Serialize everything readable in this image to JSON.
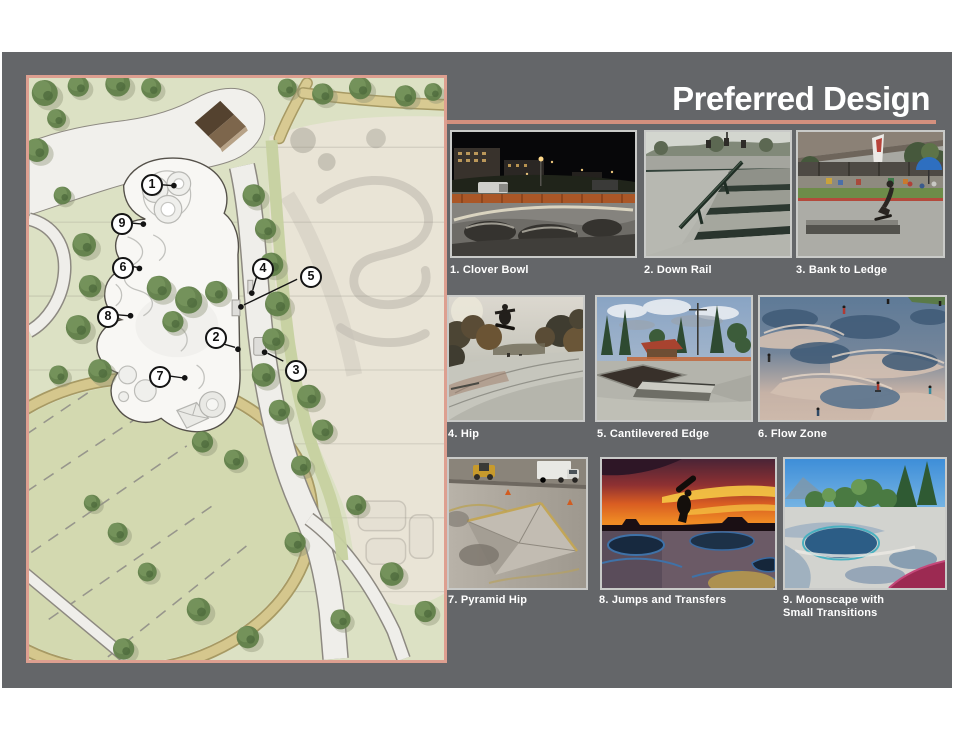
{
  "slide": {
    "title": "Preferred Design"
  },
  "colors": {
    "background": "#646669",
    "accent_salmon": "#dd9f90",
    "title_text": "#ffffff",
    "caption_text": "#ffffff",
    "photo_frame": "#c9cac8"
  },
  "site_plan": {
    "callouts": [
      {
        "number": "1"
      },
      {
        "number": "2"
      },
      {
        "number": "3"
      },
      {
        "number": "4"
      },
      {
        "number": "5"
      },
      {
        "number": "6"
      },
      {
        "number": "7"
      },
      {
        "number": "8"
      },
      {
        "number": "9"
      }
    ]
  },
  "gallery": {
    "captions": [
      "1. Clover Bowl",
      "2. Down Rail",
      "3. Bank to Ledge",
      "4. Hip",
      "5. Cantilevered Edge",
      "6. Flow Zone",
      "7. Pyramid Hip",
      "8. Jumps and Transfers",
      "9. Moonscape with Small Transitions"
    ]
  }
}
